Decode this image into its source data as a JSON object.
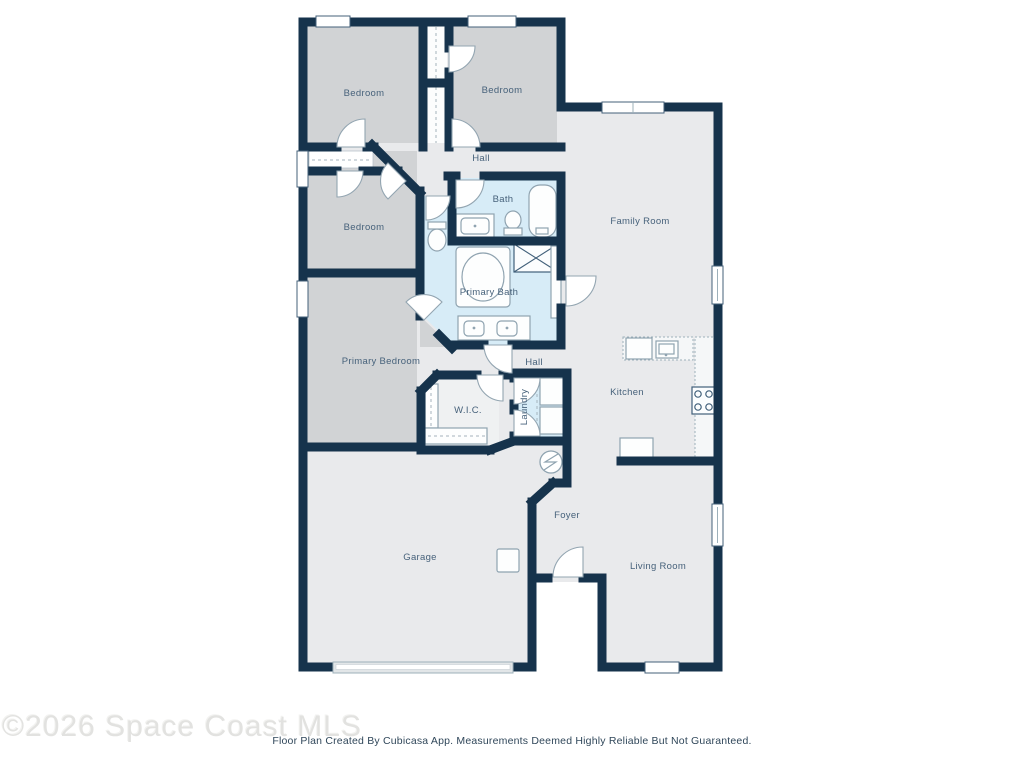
{
  "watermark": {
    "text": "©2026 Space Coast MLS"
  },
  "footer": {
    "text": "Floor Plan Created By Cubicasa App. Measurements Deemed Highly Reliable But Not Guaranteed."
  },
  "colors": {
    "wall": "#16334c",
    "bedroom_fill": "#d1d3d5",
    "living_fill": "#e9eaec",
    "bath_fill": "#d7ecf7",
    "closet_fill": "#fcfdfd",
    "wic_fill": "#eff1f2",
    "fixture_stroke": "#8fa3b0",
    "label_text": "#47627b"
  },
  "rooms": [
    {
      "id": "bedroom-1",
      "label": "Bedroom"
    },
    {
      "id": "bedroom-2",
      "label": "Bedroom"
    },
    {
      "id": "hall-upper",
      "label": "Hall"
    },
    {
      "id": "bath",
      "label": "Bath"
    },
    {
      "id": "bedroom-3",
      "label": "Bedroom"
    },
    {
      "id": "family-room",
      "label": "Family Room"
    },
    {
      "id": "primary-bath",
      "label": "Primary Bath"
    },
    {
      "id": "primary-bedroom",
      "label": "Primary Bedroom"
    },
    {
      "id": "hall-lower",
      "label": "Hall"
    },
    {
      "id": "kitchen",
      "label": "Kitchen"
    },
    {
      "id": "wic",
      "label": "W.I.C."
    },
    {
      "id": "laundry",
      "label": "Laundry"
    },
    {
      "id": "garage",
      "label": "Garage"
    },
    {
      "id": "foyer",
      "label": "Foyer"
    },
    {
      "id": "living-room",
      "label": "Living Room"
    }
  ]
}
